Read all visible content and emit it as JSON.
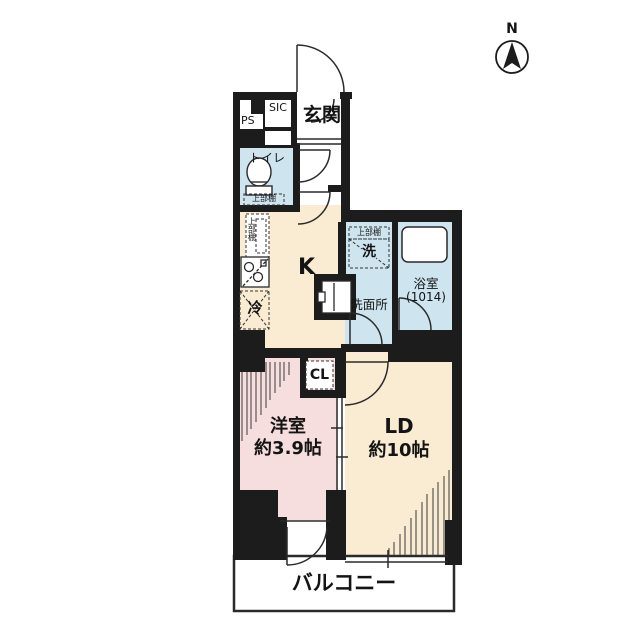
{
  "compass": {
    "label": "N"
  },
  "rooms": {
    "genkan": {
      "label": "玄関"
    },
    "sic": {
      "label": "SIC"
    },
    "ps": {
      "label": "PS"
    },
    "toilet": {
      "label": "トイレ",
      "shelf_label": "上部棚"
    },
    "kitchen": {
      "label": "K",
      "shelf_label": "上部棚",
      "fridge_label": "冷"
    },
    "washroom": {
      "label": "洗面所",
      "shelf_label": "上部棚",
      "washer_label": "洗"
    },
    "bathroom": {
      "label": "浴室",
      "size_label": "(1014)"
    },
    "closet": {
      "label": "CL"
    },
    "western_room": {
      "label": "洋室",
      "size_label": "約3.9帖"
    },
    "living_dining": {
      "label": "LD",
      "size_label": "約10帖"
    },
    "balcony": {
      "label": "バルコニー"
    }
  },
  "colors": {
    "wall": "#1c1c1c",
    "kitchen_ld_floor": "#f9ecd2",
    "western_room_floor": "#f7dede",
    "wet_area_floor": "#cee5f0",
    "line": "#2a2a2a"
  }
}
